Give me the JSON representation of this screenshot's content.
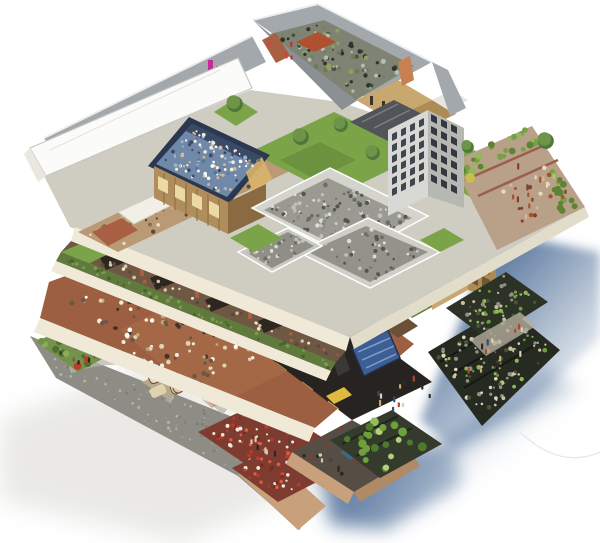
{
  "meta": {
    "title": "Isometric cutaway illustration of a multi-level mixed-use building",
    "background": "#ffffff"
  },
  "scene": {
    "type": "isometric-cutaway-illustration",
    "subject": "Isometric cutaway of a multi-level mixed-use building with rooftop courtyard, crowded pool deck, lawns, tower, terrace crowds, dining hall full of people, shops, cobbled plaza, flowerbed parterres, vegetable planter terraces and blue-gray cast shadows on white",
    "levels": [
      {
        "name": "rooftop",
        "features": [
          "walled gray courtyard with dense planting",
          "brick and timber penthouses",
          "rooftop pool deck crowded with bathers",
          "flat white roof plane",
          "lawns with trees",
          "gray high-rise tower",
          "corner terrace with crowd and hedge planters"
        ]
      },
      {
        "name": "upper-floor",
        "features": [
          "gray workshop and kitchen blocks",
          "green sedum roof bands",
          "timber-framed tower",
          "wooden deck"
        ]
      },
      {
        "name": "dining-floor",
        "features": [
          "terracotta dining hall packed with diners",
          "warm-lit storefront band",
          "dark shop band with blue mural and yellow artwork"
        ]
      },
      {
        "name": "ground-level",
        "features": [
          "cobbled plaza with light paths",
          "cream lounge sofas",
          "garden with standing visitors",
          "red flowerbed parterres",
          "vegetable planter terraces",
          "basement room with figures",
          "cabbage garden bed"
        ]
      }
    ]
  },
  "palette": {
    "background": "#ffffff",
    "shadow_blue": "#4a6b95",
    "shadow_soft": "#d9d8d3",
    "slab_cream": "#f0e9d8",
    "slab_cream_dark": "#e2dccb",
    "wall_gray": "#a3a8ac",
    "wall_gray_dark": "#8b9095",
    "courtyard_gray": "#7e8374",
    "white_roof": "#fbfbfa",
    "lawn": "#7ba449",
    "lawn_dark": "#5d8038",
    "green_roof": "#5f7a3c",
    "pool_blue": "#7089a9",
    "pool_border": "#2c3850",
    "pool_band": "#3a4a66",
    "wood": "#b08d5c",
    "wood_dark": "#8a6a40",
    "timber": "#c9a870",
    "timber_dark": "#ae8a54",
    "floor_brown": "#9d5f41",
    "floor_brown_light": "#b0744e",
    "shop_brown": "#6e5844",
    "brick": "#a85f42",
    "storefront_dark": "#262320",
    "window_warm": "#ecd9a4",
    "tower_light": "#d8d8d4",
    "tower_mid": "#b6b8b4",
    "roof_dark": "#515459",
    "terrace_paving": "#b9a089",
    "plaza": "#8e8d85",
    "path_light": "#b8b6aa",
    "garden_green": "#74924a",
    "sofa_cream": "#e8dcbf",
    "sofa_rug": "#b9a98c",
    "sofa_wood": "#6b4a2e",
    "flowerbed": "#7e3c30",
    "basement_floor": "#564e44",
    "brick_under": "#c8a17c",
    "veg_bed_dark": "#262b21",
    "mural_blue": "#3d5e94",
    "mural_light": "#7f9fc8",
    "art_yellow": "#e0ba3e",
    "drape_orange": "#c8814e",
    "banner_magenta": "#c12e96",
    "banner_red": "#d04545",
    "deck_wood": "#c49a62",
    "figure_red": "#b8352f",
    "shrub_yellow": "#c9bd4e"
  },
  "trees": [
    {
      "x": 234,
      "y": 103,
      "r": 8
    },
    {
      "x": 300,
      "y": 136,
      "r": 8
    },
    {
      "x": 340,
      "y": 124,
      "r": 7
    },
    {
      "x": 372,
      "y": 152,
      "r": 7
    },
    {
      "x": 467,
      "y": 146,
      "r": 6
    },
    {
      "x": 545,
      "y": 140,
      "r": 8
    }
  ],
  "scatters": {
    "courtyard_veg": {
      "count": 90,
      "rmin": 1,
      "rmax": 2.6,
      "seed": 11,
      "colors": [
        "#4a5042",
        "#8ca35e",
        "#b8bcb0",
        "#2f352c",
        "#6e7a5a"
      ]
    },
    "courtyard_people": {
      "count": 5,
      "rmin": 1.5,
      "rmax": 2,
      "seed": 35,
      "shapes": [
        "figure"
      ],
      "colors": [
        "#b8352f",
        "#d04545"
      ]
    },
    "pool_crowd": {
      "count": 110,
      "rmin": 1,
      "rmax": 2,
      "seed": 12,
      "colors": [
        "#f3ecda",
        "#d6b890",
        "#9fb3cc",
        "#587496",
        "#3a4a66",
        "#ffffff"
      ]
    },
    "kitchen1": {
      "count": 130,
      "rmin": 1,
      "rmax": 2.4,
      "seed": 13,
      "colors": [
        "#8f9088",
        "#c2c2ba",
        "#6c6e66",
        "#dcdcd4",
        "#55574f"
      ]
    },
    "kitchen2": {
      "count": 60,
      "rmin": 1,
      "rmax": 2.2,
      "seed": 14,
      "colors": [
        "#8f9088",
        "#c2c2ba",
        "#6c6e66",
        "#dcdcd4",
        "#55574f"
      ]
    },
    "kitchen3": {
      "count": 40,
      "rmin": 1,
      "rmax": 2,
      "seed": 36,
      "colors": [
        "#8f9088",
        "#c2c2ba",
        "#6c6e66",
        "#dcdcd4"
      ]
    },
    "plate_shops": {
      "count": 60,
      "rmin": 1,
      "rmax": 2.2,
      "seed": 34,
      "colors": [
        "#c9b08a",
        "#8a6a4a",
        "#e8e0d0",
        "#5a4a38"
      ]
    },
    "terrace_hedge": {
      "count": 30,
      "rmin": 2,
      "rmax": 4,
      "seed": 16,
      "colors": [
        "#5d8434",
        "#78a048",
        "#93b75c"
      ]
    },
    "terrace_hedge2": {
      "count": 16,
      "rmin": 2,
      "rmax": 3.6,
      "seed": 37,
      "colors": [
        "#5d8434",
        "#78a048",
        "#93b75c"
      ]
    },
    "terrace_crowd": {
      "count": 30,
      "rmin": 1.4,
      "rmax": 2.4,
      "seed": 15,
      "shapes": [
        "figure",
        "circle"
      ],
      "colors": [
        "#d6b890",
        "#a8502f",
        "#7a4430",
        "#e8d9b8",
        "#8a3a2a"
      ]
    },
    "greenband": {
      "count": 70,
      "rmin": 1,
      "rmax": 2,
      "seed": 20,
      "colors": [
        "#48622c",
        "#7e9a52",
        "#5d7a3c"
      ]
    },
    "greenroof_r1": {
      "count": 25,
      "rmin": 1,
      "rmax": 2,
      "seed": 21,
      "colors": [
        "#48622c",
        "#7e9a52",
        "#5d7a3c"
      ]
    },
    "greenroof_r2": {
      "count": 18,
      "rmin": 1,
      "rmax": 2,
      "seed": 22,
      "colors": [
        "#48622c",
        "#7e9a52",
        "#5d7a3c"
      ]
    },
    "shopstrip_people": {
      "count": 40,
      "rmin": 1.2,
      "rmax": 2,
      "seed": 19,
      "colors": [
        "#f0e8d4",
        "#d8c4a0",
        "#5a4a38",
        "#a85f42"
      ]
    },
    "dining_crowd": {
      "count": 180,
      "rmin": 1.4,
      "rmax": 2.6,
      "seed": 17,
      "colors": [
        "#f3ecda",
        "#e0d2b4",
        "#bca684",
        "#6b5844",
        "#3f362c",
        "#ffffff"
      ]
    },
    "dining_tables": {
      "count": 16,
      "rmin": 2,
      "rmax": 3,
      "seed": 18,
      "shapes": [
        "rect"
      ],
      "colors": [
        "#2e2820",
        "#3a3228"
      ]
    },
    "garden_bushes": {
      "count": 30,
      "rmin": 2,
      "rmax": 4,
      "seed": 23,
      "colors": [
        "#4e7030",
        "#8cab5c",
        "#6d9440",
        "#c0392b"
      ]
    },
    "garden_crowd": {
      "count": 20,
      "rmin": 1.4,
      "rmax": 2.2,
      "seed": 24,
      "shapes": [
        "figure"
      ],
      "colors": [
        "#3a332c",
        "#6b5f50",
        "#8a7a64",
        "#2a241e"
      ]
    },
    "cobbles": {
      "count": 130,
      "rmin": 0.8,
      "rmax": 1.6,
      "seed": 25,
      "colors": [
        "#b4b2a6",
        "#7e7d75",
        "#999890"
      ]
    },
    "flowerbed1": {
      "count": 70,
      "rmin": 1,
      "rmax": 2,
      "seed": 26,
      "colors": [
        "#c0392b",
        "#e05a44",
        "#f0e8d8",
        "#7a291f"
      ]
    },
    "flowerbed2": {
      "count": 55,
      "rmin": 1,
      "rmax": 2,
      "seed": 27,
      "colors": [
        "#c0392b",
        "#e05a44",
        "#f0e8d8",
        "#7a291f"
      ]
    },
    "bed_figures": {
      "count": 10,
      "rmin": 1.5,
      "rmax": 2.2,
      "seed": 38,
      "shapes": [
        "figure"
      ],
      "colors": [
        "#2a2622",
        "#4a4440",
        "#8a3a2a",
        "#d8cab0"
      ]
    },
    "cabbages": {
      "count": 24,
      "rmin": 2.4,
      "rmax": 4.6,
      "seed": 28,
      "colors": [
        "#6fa03c",
        "#95bb5e",
        "#b7cf7a",
        "#4e7a2c"
      ]
    },
    "vegbeds1": {
      "count": 110,
      "rmin": 1,
      "rmax": 2.4,
      "seed": 29,
      "colors": [
        "#6fa03c",
        "#8fb855",
        "#c9c0a0",
        "#8d9088",
        "#4a5438",
        "#d8d2c0"
      ]
    },
    "vegbeds2": {
      "count": 60,
      "rmin": 1,
      "rmax": 2.2,
      "seed": 30,
      "colors": [
        "#6fa03c",
        "#8fb855",
        "#c9c0a0",
        "#8d9088",
        "#4a5438"
      ]
    },
    "robed1": {
      "count": 12,
      "rmin": 2,
      "rmax": 3,
      "seed": 31,
      "shapes": [
        "figure"
      ],
      "colors": [
        "#c9a870",
        "#a84a30",
        "#3a4a6a",
        "#2e2a26",
        "#e0d0b0"
      ]
    },
    "robed2": {
      "count": 16,
      "rmin": 2,
      "rmax": 3,
      "seed": 32,
      "shapes": [
        "figure"
      ],
      "colors": [
        "#c9a870",
        "#a84a30",
        "#3a4a6a",
        "#2e2a26",
        "#e0d0b0"
      ]
    },
    "basement_people": {
      "count": 16,
      "rmin": 1.6,
      "rmax": 2.4,
      "seed": 33,
      "shapes": [
        "figure",
        "circle"
      ],
      "colors": [
        "#2a2622",
        "#4a4440",
        "#d8cab0",
        "#8a3a2a"
      ]
    }
  },
  "grids": {
    "tower_left": {
      "cols": 4,
      "rows": 6,
      "dx": 9,
      "dy": 11,
      "w": 5,
      "h": 7,
      "color": "#41454d"
    },
    "tower_right": {
      "cols": 3,
      "rows": 6,
      "dx": 10,
      "dy": 12,
      "w": 6,
      "h": 7,
      "color": "#34383f"
    },
    "timber_left": {
      "cols": 3,
      "rows": 5,
      "dx": 11,
      "dy": 17,
      "w": 7,
      "h": 12,
      "color": "#7a6340"
    },
    "timber_right": {
      "cols": 2,
      "rows": 5,
      "dx": 12,
      "dy": 17,
      "w": 8,
      "h": 12,
      "color": "#6e5838"
    },
    "pavilion_windows": {
      "cols": 4,
      "rows": 1,
      "dx": 17,
      "dy": 0,
      "w": 10,
      "h": 13,
      "color": "#ecd9a4"
    },
    "shopband_windows": {
      "cols": 6,
      "rows": 1,
      "dx": 26,
      "dy": 0,
      "w": 13,
      "h": 10,
      "color": "#ecd09a"
    },
    "storefront_windows": {
      "cols": 5,
      "rows": 1,
      "dx": 26,
      "dy": 0,
      "w": 11,
      "h": 8,
      "color": "#caa05e"
    }
  }
}
